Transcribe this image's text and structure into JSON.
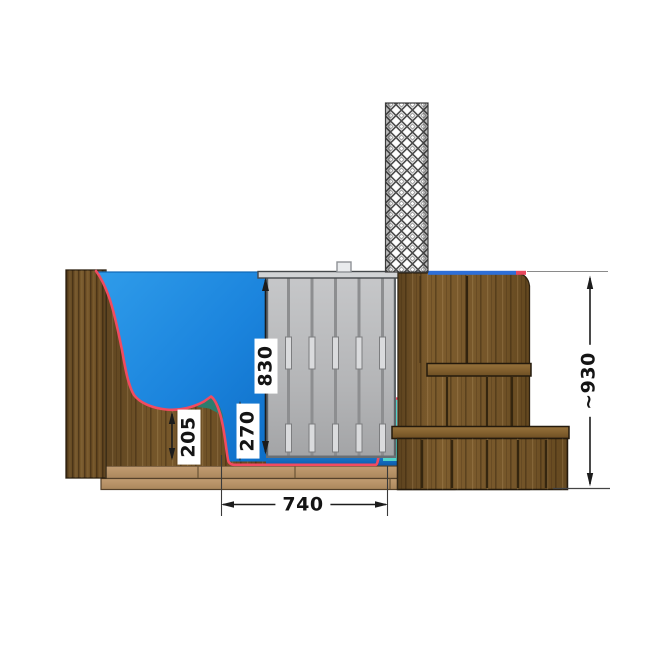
{
  "diagram": {
    "type": "technical-cross-section",
    "dimensions": {
      "inner_depth": {
        "label": "830"
      },
      "footwell_depth": {
        "label": "270"
      },
      "seat_height": {
        "label": "205"
      },
      "heater_width": {
        "label": "740"
      },
      "overall_height": {
        "label": "~930"
      }
    },
    "colors": {
      "water_blue": "#1b84dd",
      "liner_red": "#f14b60",
      "insulation_teal": "#52d3c9",
      "insulation_dark_teal": "#2c7d6d",
      "wood_brown": "#75562a",
      "base_tan": "#b8946a",
      "heater_gray": "#b9babc",
      "dimension_ink": "#1c1c1c"
    }
  }
}
